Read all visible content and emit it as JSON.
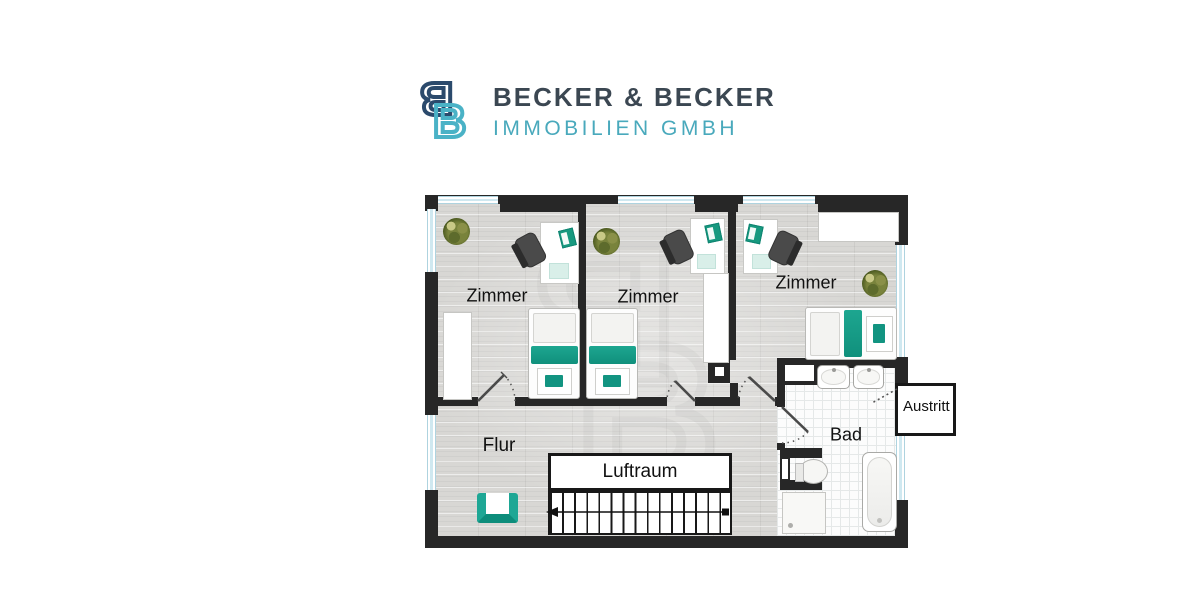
{
  "logo": {
    "mark_letter": "B",
    "title": "BECKER & BECKER",
    "subtitle": "IMMOBILIEN GMBH",
    "colors": {
      "mark_dark": "#2b4a6c",
      "mark_teal": "#4ab2c6",
      "title": "#3b4752",
      "subtitle": "#49a9bc"
    }
  },
  "plan": {
    "labels": {
      "zimmer1": "Zimmer",
      "zimmer2": "Zimmer",
      "zimmer3": "Zimmer",
      "flur": "Flur",
      "luftraum": "Luftraum",
      "bad": "Bad",
      "austritt": "Austritt"
    },
    "colors": {
      "wall": "#272727",
      "wood_floor": "#d8d7d4",
      "tile_floor": "#fcfcfc",
      "accent_teal": "#1da690",
      "window_blue": "#cfe8f0"
    }
  },
  "watermark": {
    "letter": "B"
  }
}
